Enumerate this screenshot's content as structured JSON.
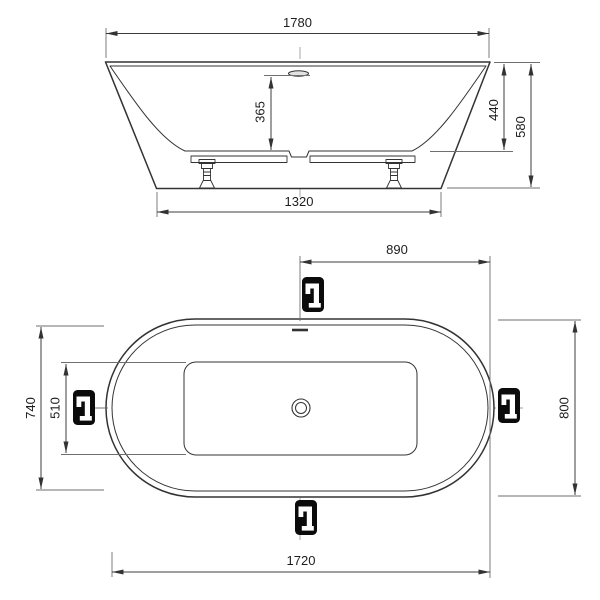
{
  "colors": {
    "background": "#ffffff",
    "outline": "#333333",
    "dimension": "#3c3c3c",
    "extension": "#6f6f6f",
    "centerline": "#9e9e9e",
    "label_text": "#1d1d1d",
    "icon_background": "#0b0b0b",
    "icon_glyph": "#ffffff",
    "overflow_fill": "#e2e2e2"
  },
  "front_view": {
    "dim_top_width": "1780",
    "dim_inner_depth": "365",
    "dim_rim_to_floor_height": "440",
    "dim_overall_height": "580",
    "dim_base_width": "1320"
  },
  "plan_view": {
    "dim_center_to_edge": "890",
    "dim_inner_rim_width": "740",
    "dim_floor_width": "510",
    "dim_overall_width": "800",
    "dim_base_length": "1720"
  },
  "icons": {
    "faucet_marker": "faucet-icon",
    "drain": "drain-icon",
    "overflow": "overflow-icon"
  }
}
